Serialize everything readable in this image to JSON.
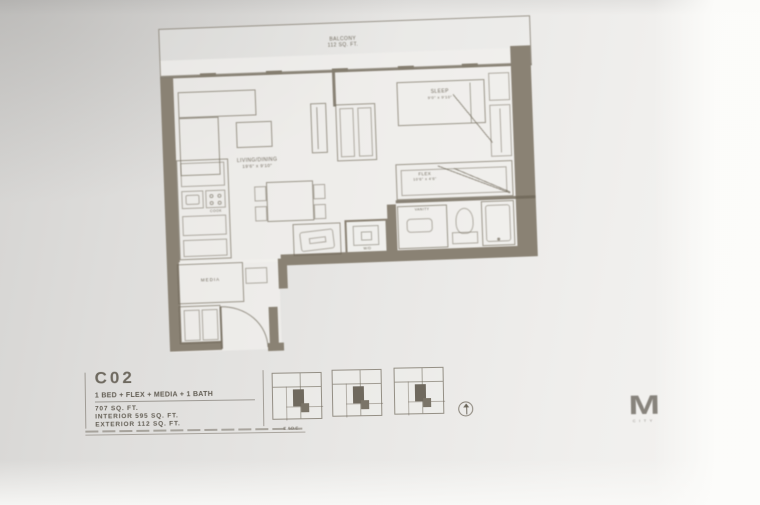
{
  "plan": {
    "balcony_label": "BALCONY",
    "balcony_area": "112 SQ. FT.",
    "living_label": "LIVING/DINING",
    "living_dims": "19'6\" x 9'10\"",
    "sleep_label": "SLEEP",
    "sleep_dims": "9'0\" x 9'10\"",
    "flex_label": "FLEX",
    "flex_dims": "10'6\" x 4'6\"",
    "media_label": "MEDIA",
    "wd_label": "W/D",
    "vanity_label": "VANITY",
    "cook_label": "COOK"
  },
  "titleblock": {
    "unit_code": "C02",
    "unit_type": "1 BED + FLEX + MEDIA + 1 BATH",
    "total_area": "707 SQ. FT.",
    "interior_area": "INTERIOR  595 SQ. FT.",
    "exterior_area": "EXTERIOR  112 SQ. FT.",
    "eoe": "E.&O.E."
  },
  "branding": {
    "logo_letter": "M",
    "logo_sub": "CITY"
  },
  "colors": {
    "wall_fill": "#8a8274",
    "line": "#8e8778",
    "plan_text": "#6f695c",
    "title_text": "#5c574e",
    "paper": "#e8e7e5"
  }
}
